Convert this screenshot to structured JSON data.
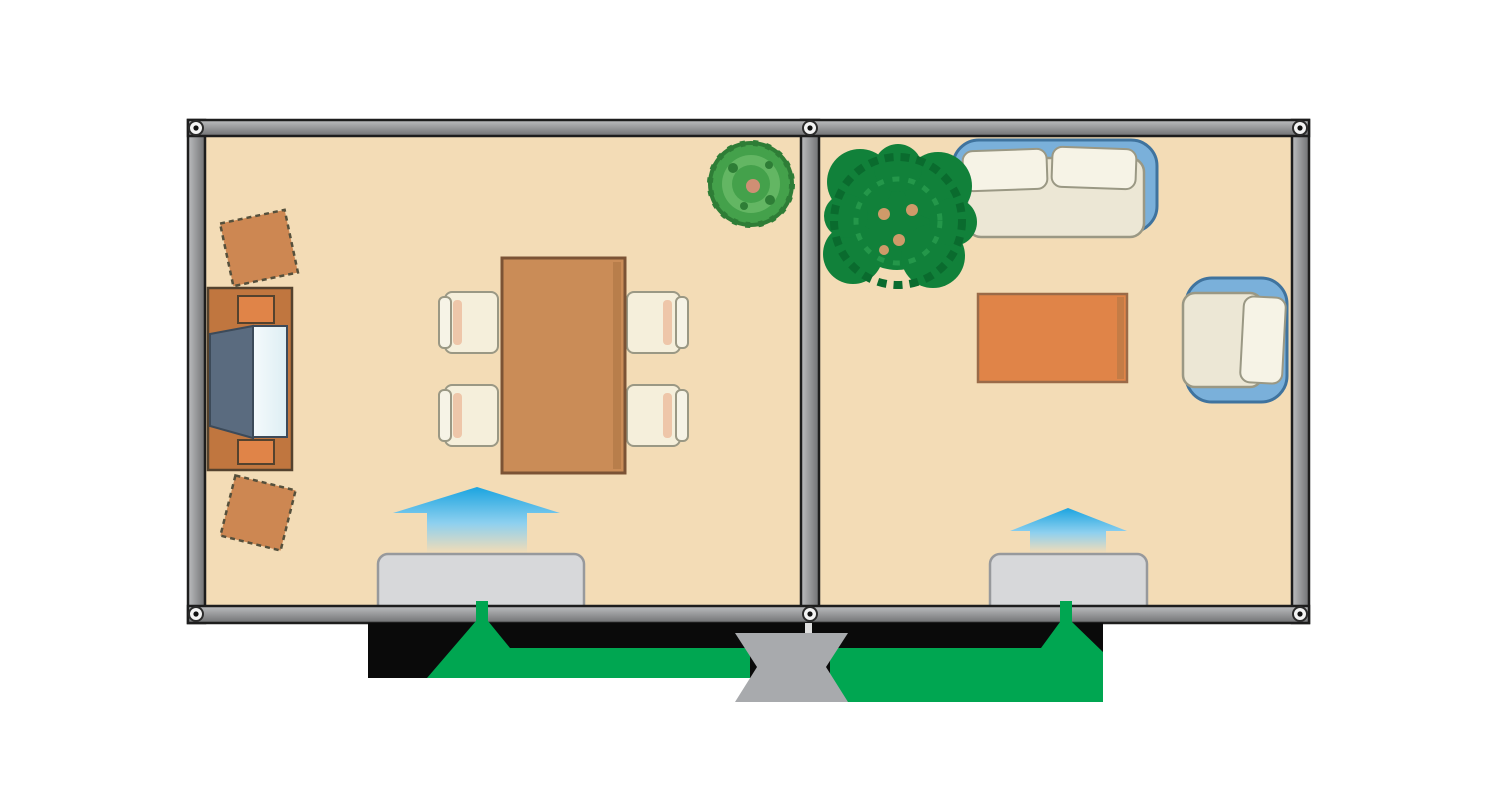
{
  "scene": {
    "type": "floor-plan-air-distribution-diagram",
    "rooms": [
      {
        "id": "dining-room",
        "furniture": [
          "tv-sideboard",
          "stool",
          "stool",
          "dining-table",
          "chair",
          "chair",
          "chair",
          "chair",
          "small-potted-plant"
        ],
        "air_outlet_unit": true,
        "supply_arrow": "up"
      },
      {
        "id": "living-room",
        "furniture": [
          "large-potted-plant",
          "sofa",
          "armchair",
          "coffee-table"
        ],
        "air_outlet_unit": true,
        "supply_arrow": "up"
      }
    ],
    "duct_network": {
      "central_junction": true,
      "branches": 2,
      "flow_direction": "junction-to-room-units"
    }
  },
  "colors": {
    "background": "#ffffff",
    "floor": "#f3dcb6",
    "wall_light": "#bdbec0",
    "wall_dark": "#707173",
    "wall_edge": "#1d1d1d",
    "screw_face": "#f4f4f4",
    "screw_ring": "#2b2b2b",
    "screw_center": "#101010",
    "duct_black": "#0a0a0a",
    "green": "#00a651",
    "junction_gray": "#a8aaad",
    "divider_gap": "#dedede",
    "unit_fill": "#d7d8da",
    "unit_edge": "#97999c",
    "arrow_blue": "#1ba4e0",
    "arrow_blue_mid": "#8ed0ef",
    "wood": "#ca8c57",
    "wood_edge": "#7b5335",
    "wood_shade": "#b07746",
    "table_edge": "#9a6a48",
    "cabinet": "#c0763f",
    "cabinet_edge": "#54422e",
    "accent_orange": "#e08448",
    "stool": "#cd8752",
    "stool_edge": "#55503c",
    "tv_body": "#5a6b7f",
    "tv_edge": "#3c4a59",
    "tv_screen": "#ddeef3",
    "uph_blue": "#7ab0da",
    "uph_blue_edge": "#3f739e",
    "cream": "#ece7d5",
    "cream_edge": "#9a9884",
    "pillow": "#f6f3e6",
    "chair_seat": "#f5efdb",
    "pink": "#eec6a9",
    "plant1": "#44a14b",
    "plant1_dark": "#2e7d36",
    "plant1_light": "#69ba67",
    "plant1_center": "#cf8f74",
    "plant2": "#11813a",
    "plant2_dark": "#0a6b2e",
    "plant2_light": "#27994d",
    "plant2_dots": "#cf9a69"
  }
}
